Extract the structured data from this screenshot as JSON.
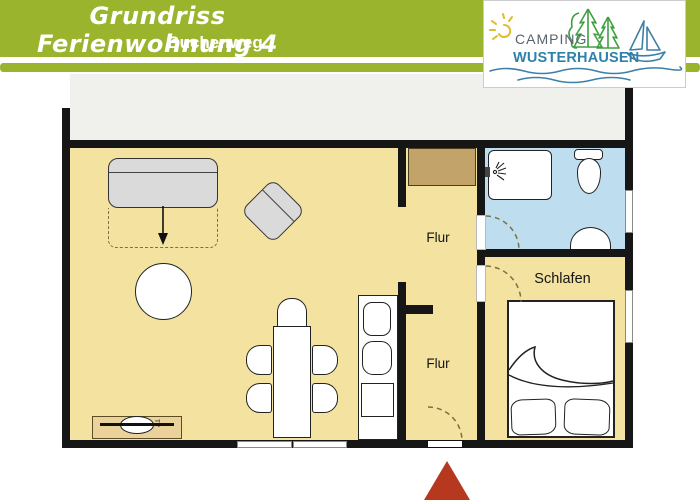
{
  "header": {
    "title": "Grundriss Ferienwohnung 4",
    "subtitle": "Buchenweg"
  },
  "logo": {
    "line1": "CAMPING",
    "line2": "WUSTERHAUSEN"
  },
  "plan": {
    "labels": {
      "flur_upper": "Flur",
      "flur_lower": "Flur",
      "bedroom": "Schlafen",
      "tv": "TV"
    }
  },
  "colors": {
    "band_green": "#9AB42E",
    "floor": "#F4E2A0",
    "bath": "#BEDEEF",
    "wall": "#161616",
    "wardrobe": "#C2A36A",
    "tv_board": "#EAD29A",
    "furniture_gray": "#DADADA",
    "dash": "#7C6F45",
    "arrow_red": "#B5381F",
    "upper_area": "#F0F0ED",
    "logo_green": "#3FA040",
    "logo_blue": "#3E7FA8",
    "logo_text": "#2E82AA",
    "logo_gray": "#5A646E",
    "sun": "#E0BC2A"
  }
}
